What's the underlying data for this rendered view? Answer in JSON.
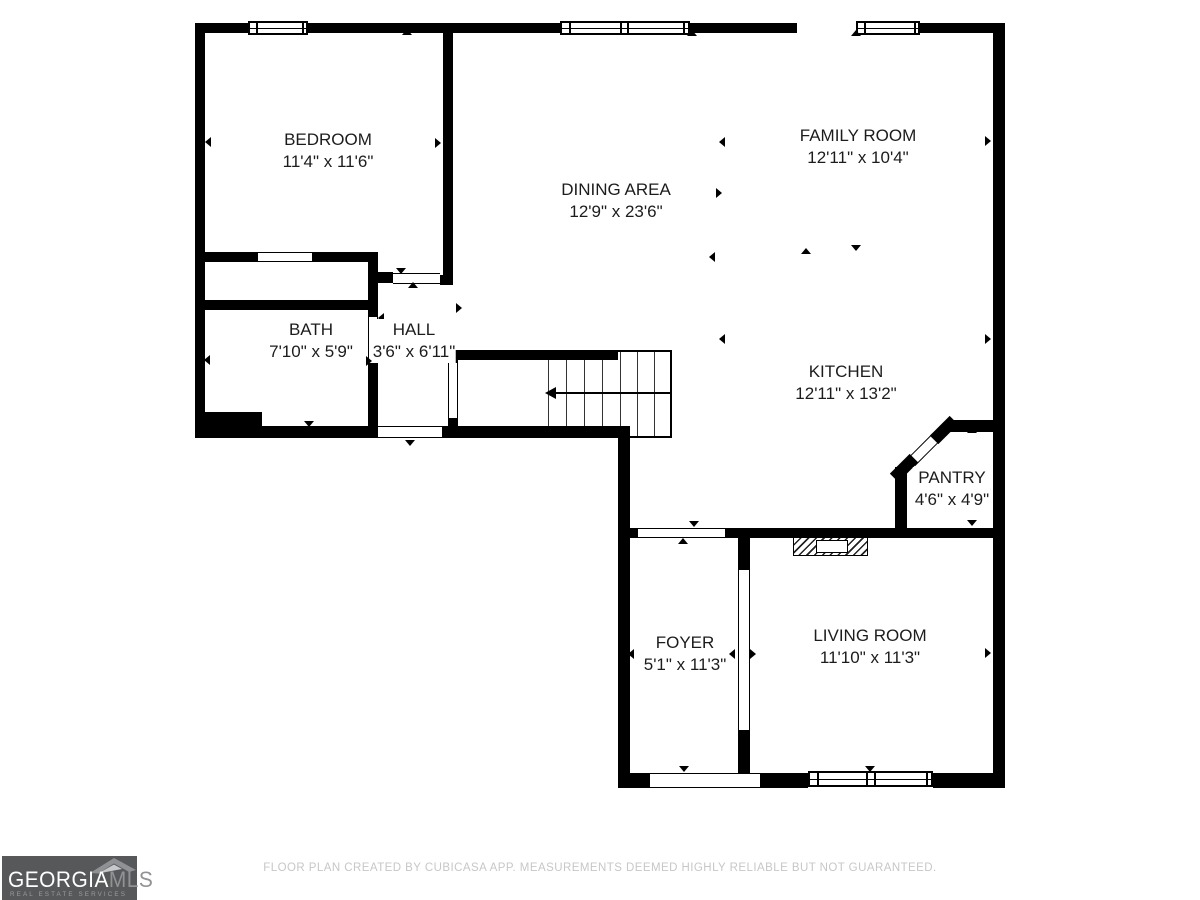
{
  "floorplan": {
    "rooms": [
      {
        "name": "BEDROOM",
        "dims": "11'4\" x 11'6\""
      },
      {
        "name": "DINING AREA",
        "dims": "12'9\" x 23'6\""
      },
      {
        "name": "FAMILY ROOM",
        "dims": "12'11\" x 10'4\""
      },
      {
        "name": "BATH",
        "dims": "7'10\" x 5'9\""
      },
      {
        "name": "HALL",
        "dims": "3'6\" x 6'11\""
      },
      {
        "name": "KITCHEN",
        "dims": "12'11\" x 13'2\""
      },
      {
        "name": "PANTRY",
        "dims": "4'6\" x 4'9\""
      },
      {
        "name": "FOYER",
        "dims": "5'1\" x 11'3\""
      },
      {
        "name": "LIVING ROOM",
        "dims": "11'10\" x 11'3\""
      }
    ]
  },
  "footer": {
    "disclaimer": "FLOOR PLAN CREATED BY CUBICASA APP. MEASUREMENTS DEEMED HIGHLY RELIABLE BUT NOT GUARANTEED."
  },
  "logo": {
    "brand_primary": "GEORGIA",
    "brand_secondary": "MLS",
    "tagline": "REAL ESTATE SERVICES"
  },
  "colors": {
    "wall": "#000000",
    "background": "#ffffff",
    "logo_background": "#57585a",
    "logo_primary_text": "#ffffff",
    "logo_secondary_text": "#909295",
    "footer_text": "#c7c7c7"
  }
}
